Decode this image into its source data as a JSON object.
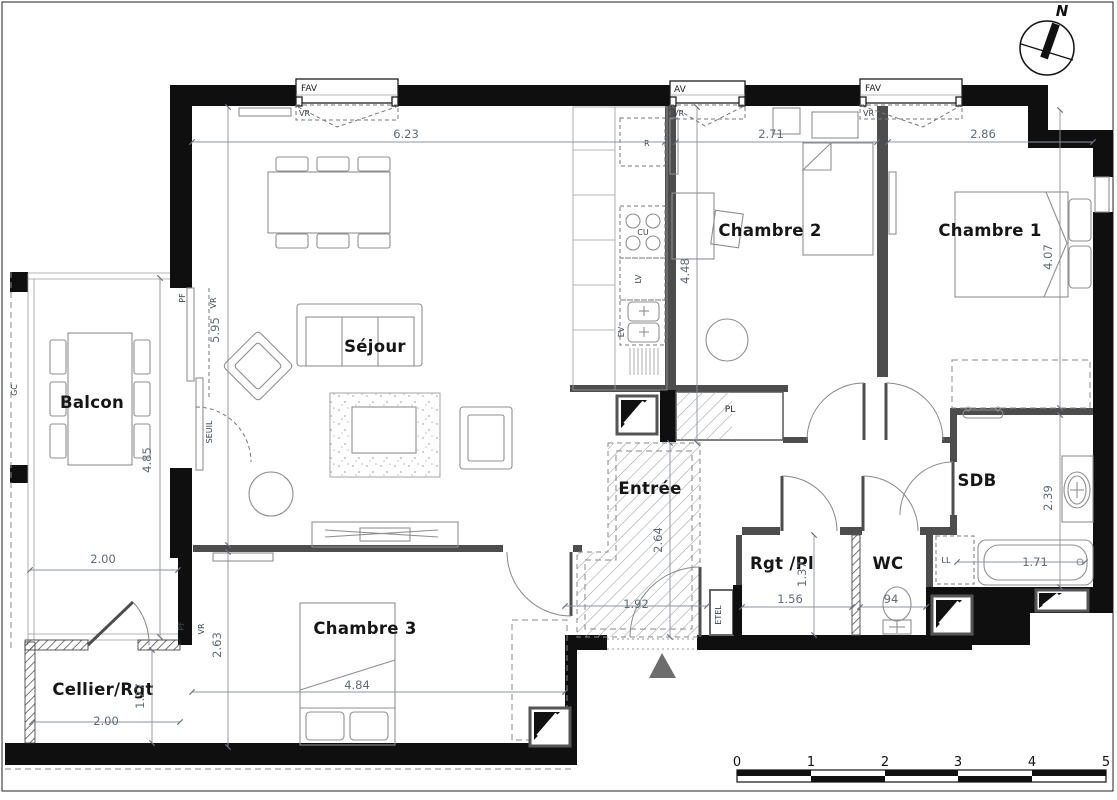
{
  "compass": {
    "north": "N"
  },
  "rooms": {
    "sejour": "Séjour",
    "balcon": "Balcon",
    "chambre1": "Chambre 1",
    "chambre2": "Chambre 2",
    "chambre3": "Chambre 3",
    "entree": "Entrée",
    "cellier": "Cellier/Rgt",
    "rgt_pl": "Rgt /Pl",
    "wc": "WC",
    "sdb": "SDB"
  },
  "dims": {
    "sejour_w": "6.23",
    "sejour_h": "5.95",
    "balcon_h": "4.85",
    "chambre2_w": "2.71",
    "chambre2_h": "4.48",
    "chambre1_w": "2.86",
    "chambre1_h": "4.07",
    "chambre3_w": "4.84",
    "chambre3_h": "2.63",
    "entree_h": "2.64",
    "entree_door_w": "1.92",
    "cellier_top_w": "2.00",
    "cellier_w": "2.00",
    "cellier_h": "1.27",
    "rgtpl_w": "1.56",
    "rgtpl_h": "1.37",
    "wc_w": "94",
    "sdb_h": "2.39",
    "tub_w": "1.71"
  },
  "annotations": {
    "fav1": "FAV",
    "vr1": "VR",
    "av": "AV",
    "vr2": "VR",
    "fav2": "FAV",
    "vr3": "VR",
    "pf_balcony": "PF",
    "vr_balcony": "VR",
    "seuil": "SEUIL",
    "pf_ch3": "PF",
    "vr_ch3": "VR",
    "gc": "GC",
    "fridge": "R",
    "cooktop": "CU",
    "dishwasher": "LV",
    "sink": "EV",
    "closet": "PL",
    "washer": "LL",
    "electrical": "ETEL"
  },
  "scale_bar": {
    "ticks": [
      "0",
      "1",
      "2",
      "3",
      "4",
      "5"
    ]
  },
  "colors": {
    "wall": "#0f0f0f",
    "partition": "#4d4d4d",
    "dim_text": "#5f6b76",
    "entrance_arrow": "#6d6d6d"
  }
}
